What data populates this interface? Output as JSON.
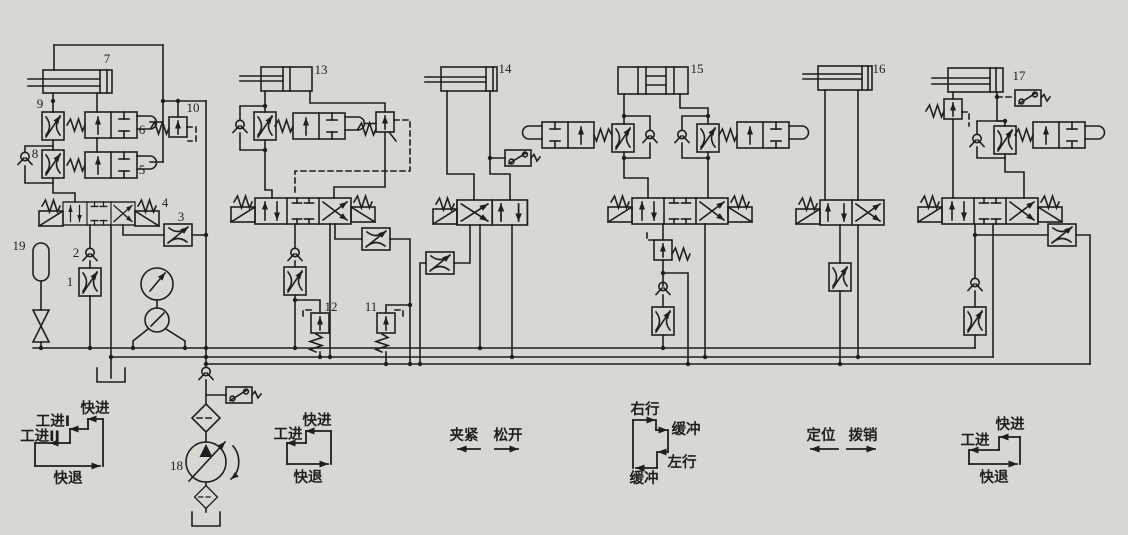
{
  "canvas": {
    "paper_color": "#d8d7d1",
    "ink_color": "#1f1f1f"
  },
  "component_numbers": {
    "c1": "1",
    "c2": "2",
    "c3": "3",
    "c4": "4",
    "c5": "5",
    "c6": "6",
    "c7": "7",
    "c8": "8",
    "c9": "9",
    "c10": "10",
    "c11": "11",
    "c12": "12",
    "c13": "13",
    "c14": "14",
    "c15": "15",
    "c16": "16",
    "c17": "17",
    "c18": "18",
    "c19": "19"
  },
  "annotations": {
    "cycle_station1": {
      "fast_advance": "快进",
      "work_feed_1": "工进I",
      "work_feed_2": "工进II",
      "fast_retreat": "快退"
    },
    "cycle_station2": {
      "fast_advance": "快进",
      "work_feed": "工进",
      "fast_retreat": "快退"
    },
    "station3": {
      "clamp": "夹紧",
      "release": "松开"
    },
    "cycle_station4": {
      "right_travel": "右行",
      "buffer_upper": "缓冲",
      "left_travel": "左行",
      "buffer_lower": "缓冲"
    },
    "station5": {
      "position": "定位",
      "pull_pin": "拨销"
    },
    "cycle_station6": {
      "work_feed": "工进",
      "fast_advance": "快进",
      "fast_retreat": "快退"
    }
  }
}
